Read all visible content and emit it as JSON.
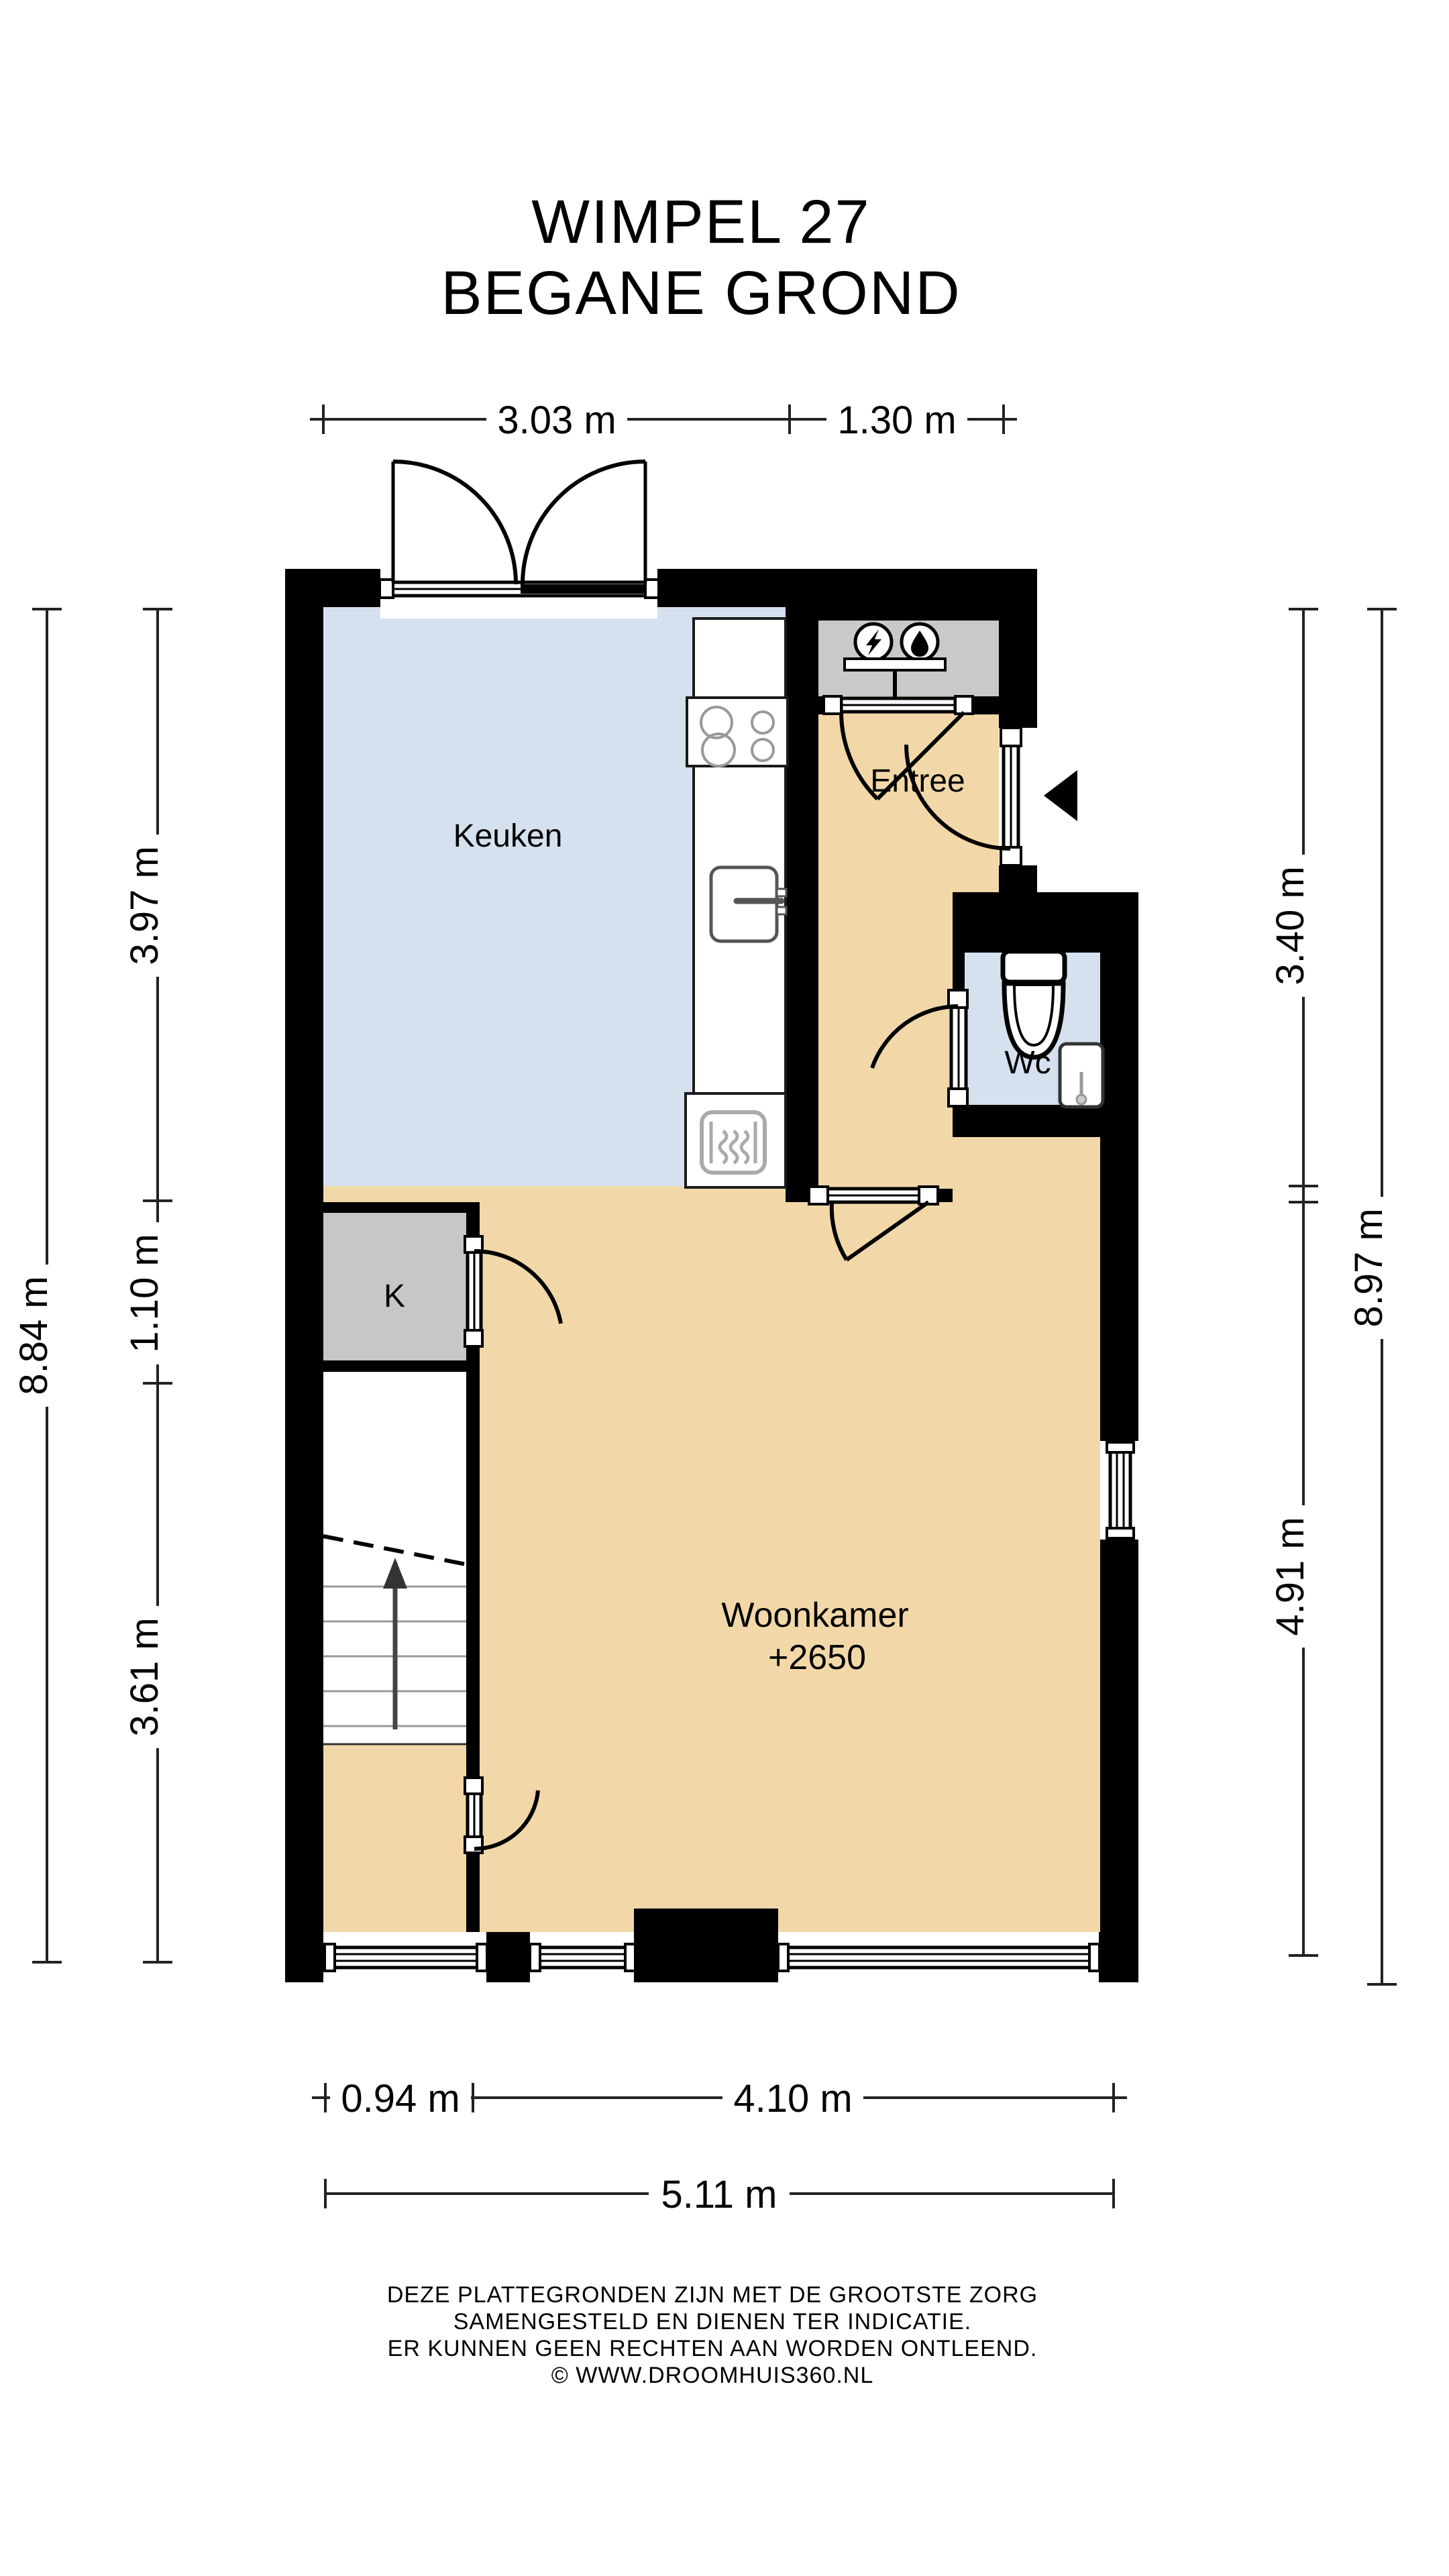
{
  "title": {
    "line1": "WIMPEL 27",
    "line2": "BEGANE GROND"
  },
  "rooms": {
    "kitchen": "Keuken",
    "entry": "Entree",
    "toilet": "Wc",
    "living_name": "Woonkamer",
    "living_level": "+2650",
    "closet": "K"
  },
  "dimensions": {
    "top": [
      "3.03 m",
      "1.30 m"
    ],
    "left_outer": "8.84 m",
    "left_inner": [
      "3.97 m",
      "1.10 m",
      "3.61 m"
    ],
    "right_inner": [
      "3.40 m",
      "4.91 m"
    ],
    "right_outer": "8.97 m",
    "bottom_inner": [
      "0.94 m",
      "4.10 m"
    ],
    "bottom_outer": "5.11 m"
  },
  "disclaimer": {
    "line1": "DEZE PLATTEGRONDEN ZIJN MET DE GROOTSTE ZORG",
    "line2": "SAMENGESTELD EN DIENEN TER INDICATIE.",
    "line3": "ER KUNNEN GEEN RECHTEN AAN WORDEN ONTLEEND.",
    "line4": "© WWW.DROOMHUIS360.NL"
  },
  "icons": {
    "meter_cupboard": [
      "electricity-icon",
      "water-icon"
    ],
    "entrance_marker": "entrance-arrow-icon",
    "stairs_marker": "stairs-up-arrow-icon"
  },
  "colors": {
    "wall": "#000000",
    "floor_tan": "#F2D8A8",
    "room_blue": "#D5E1EE",
    "closet_gray": "#C7C7C7",
    "fixture_gray": "#A9A9A9"
  }
}
